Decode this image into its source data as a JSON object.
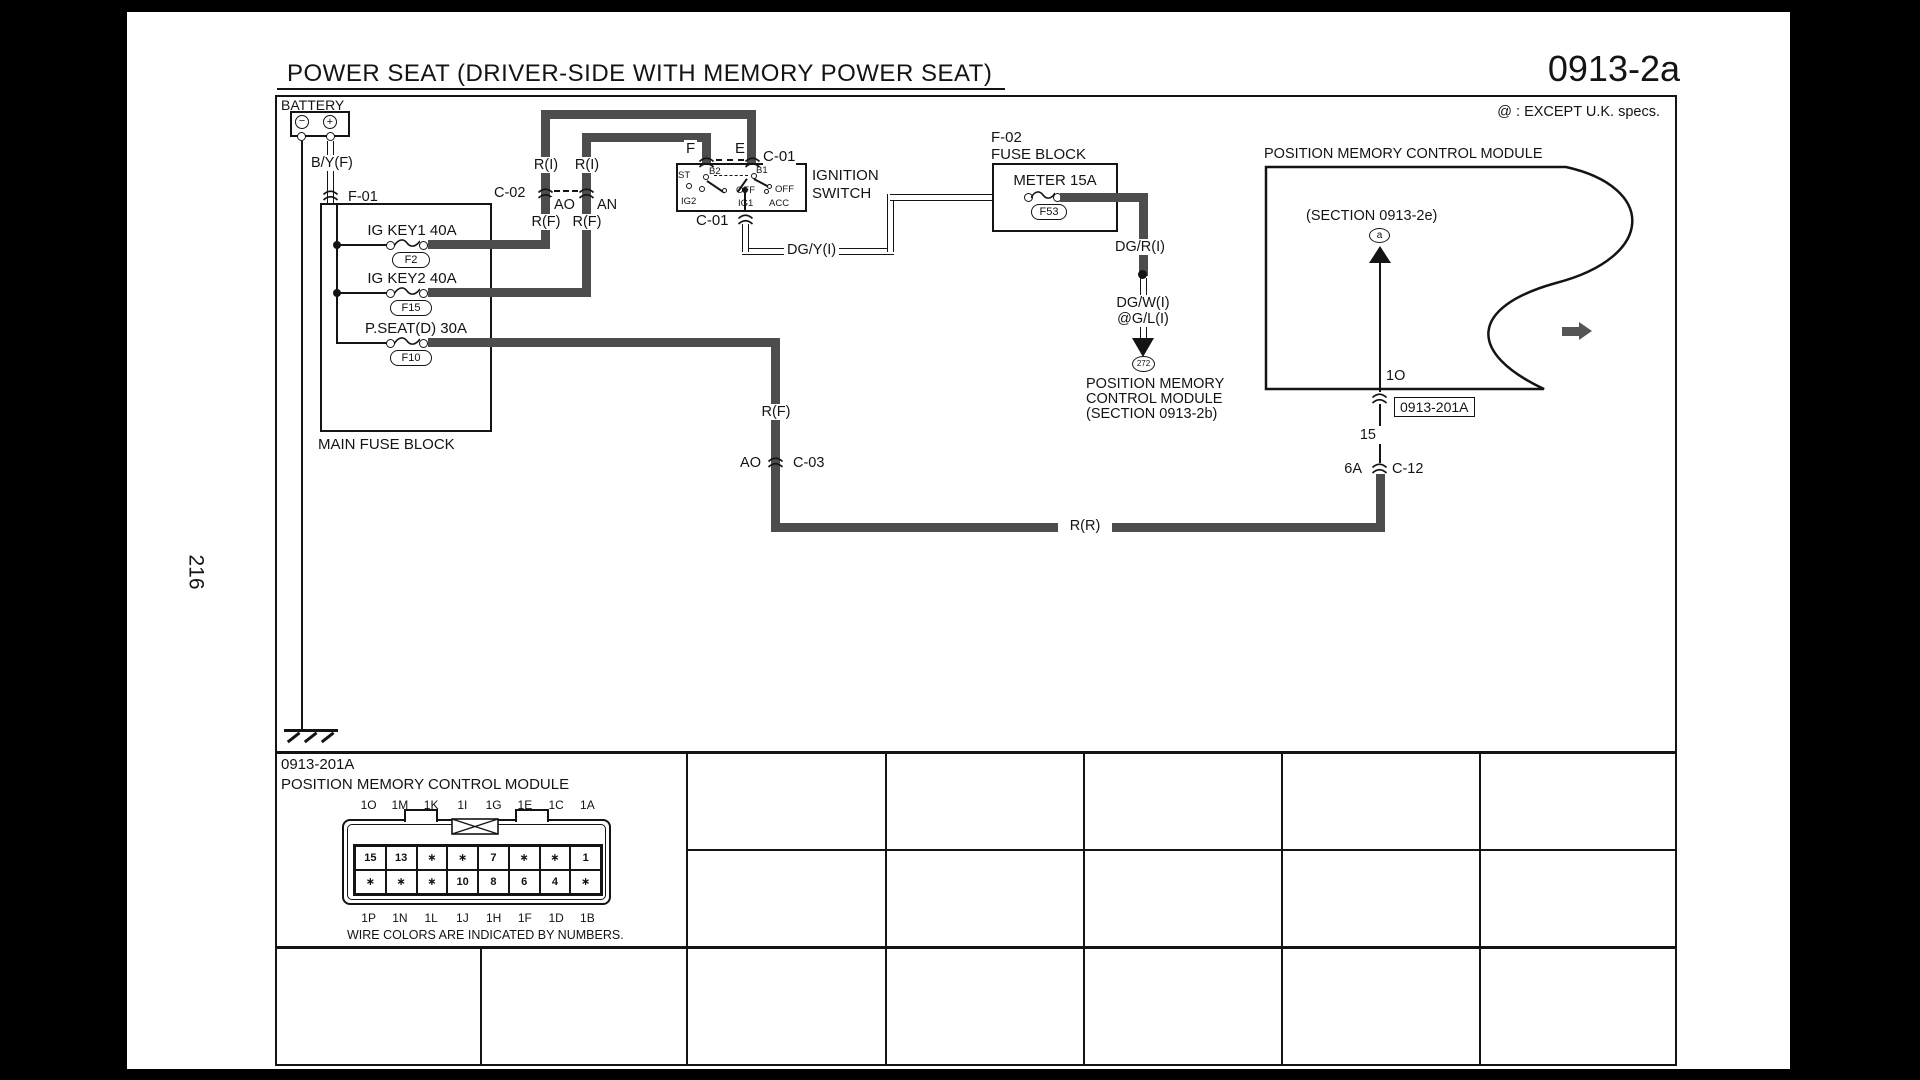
{
  "page": {
    "number": "216",
    "title": "POWER SEAT (DRIVER-SIDE WITH MEMORY POWER SEAT)",
    "code": "0913-2a",
    "note": "@ : EXCEPT U.K. specs."
  },
  "battery": {
    "label": "BATTERY",
    "minus": "−",
    "plus": "+",
    "wire": "B/Y(F)",
    "connector": "F-01"
  },
  "main_fuse_block": {
    "label": "MAIN FUSE BLOCK",
    "fuses": [
      {
        "name": "IG KEY1 40A",
        "id": "F2"
      },
      {
        "name": "IG KEY2 40A",
        "id": "F15"
      },
      {
        "name": "P.SEAT(D) 30A",
        "id": "F10"
      }
    ]
  },
  "c02": {
    "label": "C-02",
    "left_above": "R(I)",
    "right_above": "R(I)",
    "left_pin": "AO",
    "right_pin": "AN",
    "left_below": "R(F)",
    "right_below": "R(F)"
  },
  "ignition_switch": {
    "name_line1": "IGNITION",
    "name_line2": "SWITCH",
    "pin_f": "F",
    "pin_e": "E",
    "connector_top": "C-01",
    "connector_bottom": "C-01",
    "st": "ST",
    "b2": "B2",
    "b1": "B1",
    "off_left": "OFF",
    "off_right": "OFF",
    "ig2": "IG2",
    "ig1": "IG1",
    "acc": "ACC"
  },
  "f02_block": {
    "id": "F-02",
    "label": "FUSE BLOCK",
    "fuse_name": "METER 15A",
    "fuse_id": "F53"
  },
  "dg_wires": {
    "dg_y": "DG/Y(I)",
    "dg_r": "DG/R(I)",
    "dg_w": "DG/W(I)",
    "dg_w_uk": "@G/L(I)",
    "dest_circle": "272",
    "dest_line1": "POSITION MEMORY",
    "dest_line2": "CONTROL MODULE",
    "dest_line3": "(SECTION 0913-2b)"
  },
  "module": {
    "title": "POSITION MEMORY CONTROL MODULE",
    "section": "(SECTION 0913-2e)",
    "point": "a",
    "pin_top": "1O",
    "ref_box": "0913-201A",
    "pin_mid": "15",
    "pin_bottom": "6A",
    "connector": "C-12"
  },
  "r_wires": {
    "rf_col": "R(F)",
    "rr": "R(R)",
    "c03_pin": "AO",
    "c03": "C-03"
  },
  "connector_table": {
    "ref": "0913-201A",
    "name": "POSITION MEMORY CONTROL MODULE",
    "pins_top": [
      "1O",
      "1M",
      "1K",
      "1I",
      "1G",
      "1E",
      "1C",
      "1A"
    ],
    "pins_bottom": [
      "1P",
      "1N",
      "1L",
      "1J",
      "1H",
      "1F",
      "1D",
      "1B"
    ],
    "grid_row1": [
      "15",
      "13",
      "∗",
      "∗",
      "7",
      "∗",
      "∗",
      "1"
    ],
    "grid_row2": [
      "∗",
      "∗",
      "∗",
      "10",
      "8",
      "6",
      "4",
      "∗"
    ],
    "note": "WIRE COLORS ARE INDICATED BY NUMBERS."
  }
}
